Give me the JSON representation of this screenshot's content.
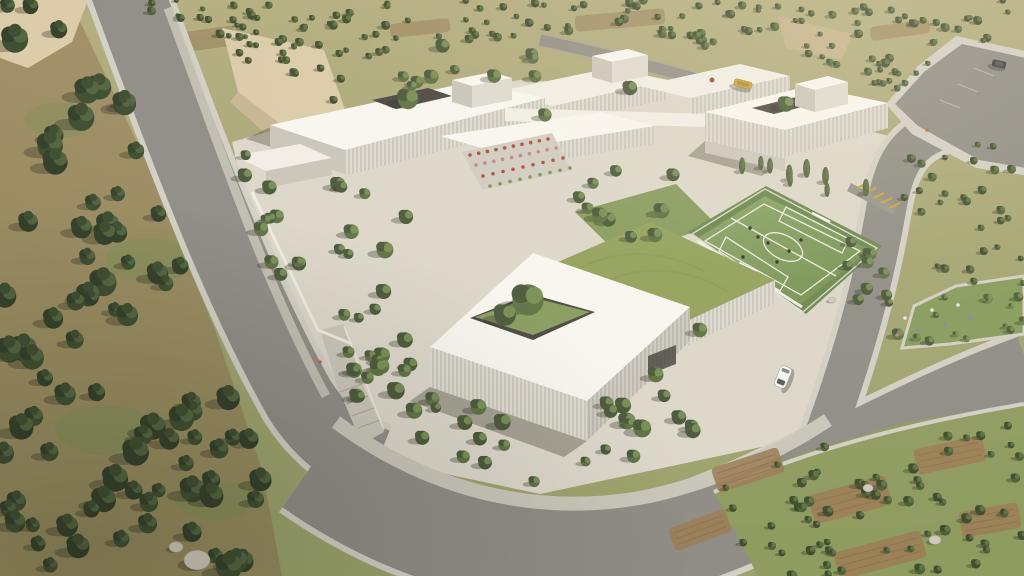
{
  "scene": {
    "kind": "aerial-architectural-render",
    "canvas": {
      "w": 1024,
      "h": 576
    }
  },
  "palette": {
    "terrainTop": "#b4ad80",
    "terrainBottom": "#9aa36b",
    "grass": "#7e9055",
    "earth": "#8f7250",
    "earthLight": "#9c7e58",
    "garden": "#8f9c60",
    "lawn": "#879c5e",
    "road": "#8f8d86",
    "curb": "#d2cfc5",
    "walk": "#cac6ba",
    "plaza": "#dcd7ca",
    "roofWhite": "#f1eee6",
    "roofBright": "#f8f6f0",
    "louver": "#dedad0",
    "louverLine": "#b5b1a7",
    "facadeShade": "#c9c5ba",
    "opening": "#4a4741",
    "field": "#7a955c",
    "fieldDark": "#6d8750",
    "fieldLine": "#eceae2",
    "greenRoof": "#93a25c",
    "cliff": "#c8b591",
    "cliffLight": "#dbcba9",
    "shadow": "rgba(45,42,32,0.32)",
    "pine": "#3e4e31",
    "pineDark": "#33402a",
    "pineLight": "#556743",
    "olive": "#4e5f3a",
    "oliveDark": "#3f4e2e",
    "oliveLight": "#657748",
    "tree": "#5d7244",
    "treeDark": "#49593a",
    "treeLight": "#7b9158",
    "poplar": "#55683f",
    "shrub": "#6d8348",
    "flowerRed": "#b0483e",
    "flowerPink": "#c8808b",
    "flowerWhite": "#e9e6dd",
    "flowerPurple": "#8d80b0",
    "carWhite": "#f4f4f2",
    "carDark": "#3c3d40",
    "busYellow": "#c8a23c",
    "person": "#c06b33",
    "rock": "#cfcabc",
    "player": "#33302a"
  },
  "vegetation": {
    "regions": [
      {
        "name": "olive-grove-north",
        "type": "olive",
        "seed": 13,
        "count": 150,
        "sizeMin": 0.55,
        "sizeMax": 1.0,
        "polygon": [
          [
            95,
            0
          ],
          [
            1024,
            0
          ],
          [
            1024,
            38
          ],
          [
            962,
            44
          ],
          [
            905,
            98
          ],
          [
            820,
            60
          ],
          [
            700,
            52
          ],
          [
            600,
            30
          ],
          [
            470,
            40
          ],
          [
            360,
            58
          ],
          [
            250,
            44
          ],
          [
            170,
            18
          ]
        ]
      },
      {
        "name": "olive-hill-center",
        "type": "olive",
        "seed": 137,
        "count": 16,
        "sizeMin": 0.6,
        "sizeMax": 0.95,
        "polygon": [
          [
            195,
            18
          ],
          [
            345,
            48
          ],
          [
            350,
            112
          ],
          [
            318,
            95
          ],
          [
            235,
            58
          ]
        ]
      },
      {
        "name": "north-terrace-trees",
        "type": "tree",
        "seed": 83,
        "count": 10,
        "sizeMin": 0.7,
        "sizeMax": 1.2,
        "polygon": [
          [
            350,
            60
          ],
          [
            480,
            40
          ],
          [
            600,
            52
          ],
          [
            540,
            80
          ],
          [
            420,
            92
          ]
        ]
      },
      {
        "name": "olive-grove-northeast",
        "type": "olive",
        "seed": 29,
        "count": 28,
        "sizeMin": 0.6,
        "sizeMax": 1.0,
        "polygon": [
          [
            920,
            140
          ],
          [
            1024,
            145
          ],
          [
            1024,
            265
          ],
          [
            950,
            290
          ],
          [
            900,
            235
          ],
          [
            905,
            170
          ]
        ]
      },
      {
        "name": "olive-garden-southeast",
        "type": "olive",
        "seed": 41,
        "count": 65,
        "sizeMin": 0.7,
        "sizeMax": 1.2,
        "polygon": [
          [
            758,
            576
          ],
          [
            714,
            492
          ],
          [
            800,
            454
          ],
          [
            906,
            422
          ],
          [
            1024,
            404
          ],
          [
            1024,
            576
          ]
        ]
      },
      {
        "name": "campus-garden-south",
        "type": "tree",
        "seed": 53,
        "count": 40,
        "sizeMin": 0.8,
        "sizeMax": 1.5,
        "polygon": [
          [
            335,
            335
          ],
          [
            405,
            360
          ],
          [
            470,
            395
          ],
          [
            540,
            420
          ],
          [
            610,
            400
          ],
          [
            680,
            355
          ],
          [
            735,
            395
          ],
          [
            660,
            460
          ],
          [
            540,
            485
          ],
          [
            430,
            455
          ],
          [
            350,
            405
          ]
        ]
      },
      {
        "name": "plaza-trees-west",
        "type": "tree",
        "seed": 61,
        "count": 13,
        "sizeMin": 0.8,
        "sizeMax": 1.3,
        "polygon": [
          [
            258,
            165
          ],
          [
            360,
            185
          ],
          [
            420,
            210
          ],
          [
            430,
            300
          ],
          [
            350,
            330
          ],
          [
            285,
            255
          ]
        ]
      },
      {
        "name": "courtyard-plaza-trees",
        "type": "tree",
        "seed": 97,
        "count": 8,
        "sizeMin": 0.9,
        "sizeMax": 1.4,
        "polygon": [
          [
            560,
            180
          ],
          [
            660,
            160
          ],
          [
            700,
            200
          ],
          [
            640,
            250
          ],
          [
            575,
            240
          ]
        ]
      },
      {
        "name": "roadside-row-west",
        "type": "tree",
        "seed": 101,
        "count": 9,
        "sizeMin": 0.8,
        "sizeMax": 1.2,
        "polygon": [
          [
            235,
            150
          ],
          [
            275,
            160
          ],
          [
            330,
            320
          ],
          [
            300,
            330
          ],
          [
            250,
            220
          ]
        ]
      },
      {
        "name": "field-edge-trees",
        "type": "tree",
        "seed": 71,
        "count": 11,
        "sizeMin": 0.7,
        "sizeMax": 1.1,
        "polygon": [
          [
            860,
            230
          ],
          [
            905,
            255
          ],
          [
            930,
            300
          ],
          [
            900,
            340
          ],
          [
            845,
            300
          ],
          [
            820,
            270
          ]
        ]
      },
      {
        "name": "shrubs-northeast-bed",
        "type": "shrub",
        "seed": 113,
        "count": 14,
        "sizeMin": 0.8,
        "sizeMax": 1.4,
        "polygon": [
          [
            902,
            348
          ],
          [
            916,
            308
          ],
          [
            958,
            288
          ],
          [
            1024,
            278
          ],
          [
            1024,
            330
          ],
          [
            950,
            342
          ]
        ]
      },
      {
        "name": "poplar-row",
        "type": "poplar",
        "seed": 127,
        "count": 9,
        "sizeMin": 0.9,
        "sizeMax": 1.2,
        "polygon": [
          [
            740,
            150
          ],
          [
            870,
            185
          ],
          [
            868,
            202
          ],
          [
            738,
            167
          ]
        ]
      },
      {
        "name": "pine-forest-west",
        "type": "pine",
        "seed": 7,
        "count": 85,
        "sizeMin": 0.9,
        "sizeMax": 1.9,
        "polygon": [
          [
            0,
            0
          ],
          [
            78,
            0
          ],
          [
            150,
            160
          ],
          [
            215,
            320
          ],
          [
            262,
            460
          ],
          [
            282,
            576
          ],
          [
            0,
            576
          ]
        ]
      }
    ],
    "fixedTrees": [
      {
        "name": "courtyard-tree-main",
        "type": "tree",
        "x": 528,
        "y": 300,
        "s": 2.6
      },
      {
        "name": "courtyard-tree-secondary",
        "type": "tree",
        "x": 505,
        "y": 315,
        "s": 1.8
      },
      {
        "name": "roof-courtyard-tree-a",
        "type": "tree",
        "x": 408,
        "y": 99,
        "s": 1.7
      },
      {
        "name": "roof-courtyard-tree-c",
        "type": "tree",
        "x": 786,
        "y": 104,
        "s": 1.3
      },
      {
        "name": "roof-courtyard-tree-b",
        "type": "tree",
        "x": 630,
        "y": 88,
        "s": 1.2
      },
      {
        "name": "plaza-tree-1",
        "type": "tree",
        "x": 600,
        "y": 215,
        "s": 1.3
      },
      {
        "name": "plaza-tree-2",
        "type": "tree",
        "x": 655,
        "y": 235,
        "s": 1.2
      },
      {
        "name": "west-court-tree",
        "type": "tree",
        "x": 385,
        "y": 250,
        "s": 1.4
      },
      {
        "name": "north-cluster-tree",
        "type": "tree",
        "x": 545,
        "y": 115,
        "s": 1.1
      },
      {
        "name": "ramp-tree",
        "type": "tree",
        "x": 405,
        "y": 340,
        "s": 1.3
      },
      {
        "name": "se-corner-tree",
        "type": "tree",
        "x": 700,
        "y": 330,
        "s": 1.2
      }
    ]
  },
  "flowers": {
    "terraceRows": [
      {
        "x1": 470,
        "y1": 155,
        "x2": 548,
        "y2": 139,
        "color": "flowerRed",
        "n": 10
      },
      {
        "x1": 476,
        "y1": 165,
        "x2": 556,
        "y2": 148,
        "color": "flowerPink",
        "n": 10
      },
      {
        "x1": 483,
        "y1": 176,
        "x2": 563,
        "y2": 158,
        "color": "flowerRed",
        "n": 9
      },
      {
        "x1": 490,
        "y1": 186,
        "x2": 570,
        "y2": 168,
        "color": "grass",
        "n": 9
      }
    ],
    "bedDots": [
      {
        "x": 905,
        "y": 318,
        "color": "flowerWhite"
      },
      {
        "x": 918,
        "y": 330,
        "color": "flowerPurple"
      },
      {
        "x": 932,
        "y": 310,
        "color": "flowerWhite"
      },
      {
        "x": 945,
        "y": 325,
        "color": "flowerPurple"
      },
      {
        "x": 897,
        "y": 335,
        "color": "flowerPink"
      },
      {
        "x": 958,
        "y": 305,
        "color": "flowerWhite"
      },
      {
        "x": 970,
        "y": 318,
        "color": "flowerPurple"
      }
    ]
  },
  "earthPatches": {
    "north": [
      {
        "cx": 200,
        "cy": 40,
        "w": 70,
        "h": 20,
        "rot": -8
      },
      {
        "cx": 620,
        "cy": 20,
        "w": 90,
        "h": 16,
        "rot": -5
      },
      {
        "cx": 900,
        "cy": 30,
        "w": 60,
        "h": 14,
        "rot": -8
      },
      {
        "cx": 420,
        "cy": 28,
        "w": 60,
        "h": 14,
        "rot": -6
      }
    ],
    "se": [
      {
        "cx": 748,
        "cy": 470,
        "w": 70,
        "h": 26,
        "rot": -18
      },
      {
        "cx": 850,
        "cy": 500,
        "w": 80,
        "h": 30,
        "rot": -15
      },
      {
        "cx": 950,
        "cy": 455,
        "w": 70,
        "h": 26,
        "rot": -12
      },
      {
        "cx": 880,
        "cy": 555,
        "w": 90,
        "h": 28,
        "rot": -15
      },
      {
        "cx": 700,
        "cy": 530,
        "w": 60,
        "h": 24,
        "rot": -20
      },
      {
        "cx": 990,
        "cy": 520,
        "w": 60,
        "h": 26,
        "rot": -10
      }
    ]
  },
  "objects": {
    "cars": [
      {
        "name": "white-car",
        "x": 783,
        "y": 377,
        "rot": -68,
        "type": "white"
      },
      {
        "name": "parked-car",
        "x": 999,
        "y": 64,
        "rot": 12,
        "type": "dark"
      }
    ],
    "bus": {
      "x": 743,
      "y": 84,
      "rot": 14
    },
    "people": [
      {
        "x": 320,
        "y": 362
      },
      {
        "x": 927,
        "y": 130
      }
    ],
    "rocks": [
      {
        "x": 197,
        "y": 560,
        "r": 13
      },
      {
        "x": 176,
        "y": 547,
        "r": 7
      },
      {
        "x": 868,
        "y": 488,
        "r": 5
      },
      {
        "x": 935,
        "y": 540,
        "r": 6
      },
      {
        "x": 832,
        "y": 300,
        "r": 4
      }
    ]
  },
  "field": {
    "players": [
      [
        750,
        228
      ],
      [
        768,
        243
      ],
      [
        789,
        251
      ],
      [
        743,
        257
      ],
      [
        777,
        262
      ],
      [
        801,
        240
      ],
      [
        758,
        237
      ]
    ]
  }
}
